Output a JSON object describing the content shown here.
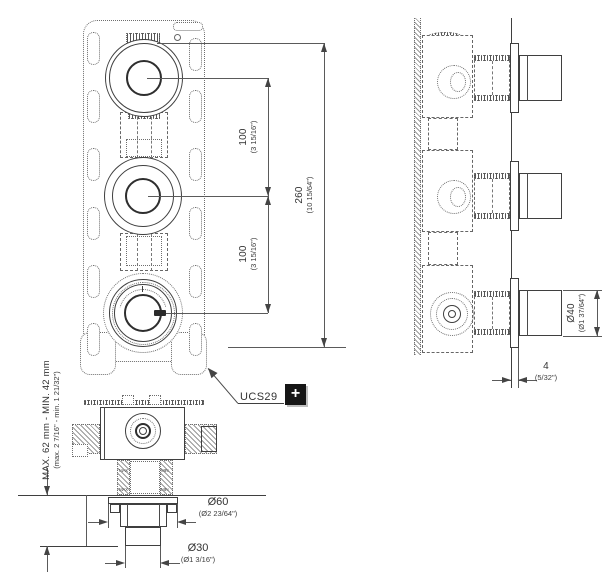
{
  "product": {
    "code": "UCS29",
    "badge": "+"
  },
  "dims": {
    "spacing": {
      "metric": "100",
      "imperial": "(3 15/16\")"
    },
    "height": {
      "metric": "260",
      "imperial": "(10 15/64\")"
    },
    "handle": {
      "metric": "Ø40",
      "imperial": "(Ø1 37/64\")"
    },
    "offset": {
      "metric": "4",
      "imperial": "(5/32\")"
    },
    "escutcheon": {
      "metric": "Ø60",
      "imperial": "(Ø2 23/64\")"
    },
    "spout": {
      "metric": "Ø30",
      "imperial": "(Ø1 3/16\")"
    },
    "depth": {
      "metric": "MAX. 62 mm - MIN. 42 mm",
      "imperial": "(max. 2 7/16\" - min. 1 21/32\")"
    }
  },
  "engravings": {
    "max": "MAX",
    "min": "MIN"
  },
  "colors": {
    "line": "#3f3f3f",
    "dim_line": "#5a5a5a",
    "text": "#333333",
    "badge_bg": "#161616",
    "badge_fg": "#ffffff",
    "background": "#ffffff"
  }
}
